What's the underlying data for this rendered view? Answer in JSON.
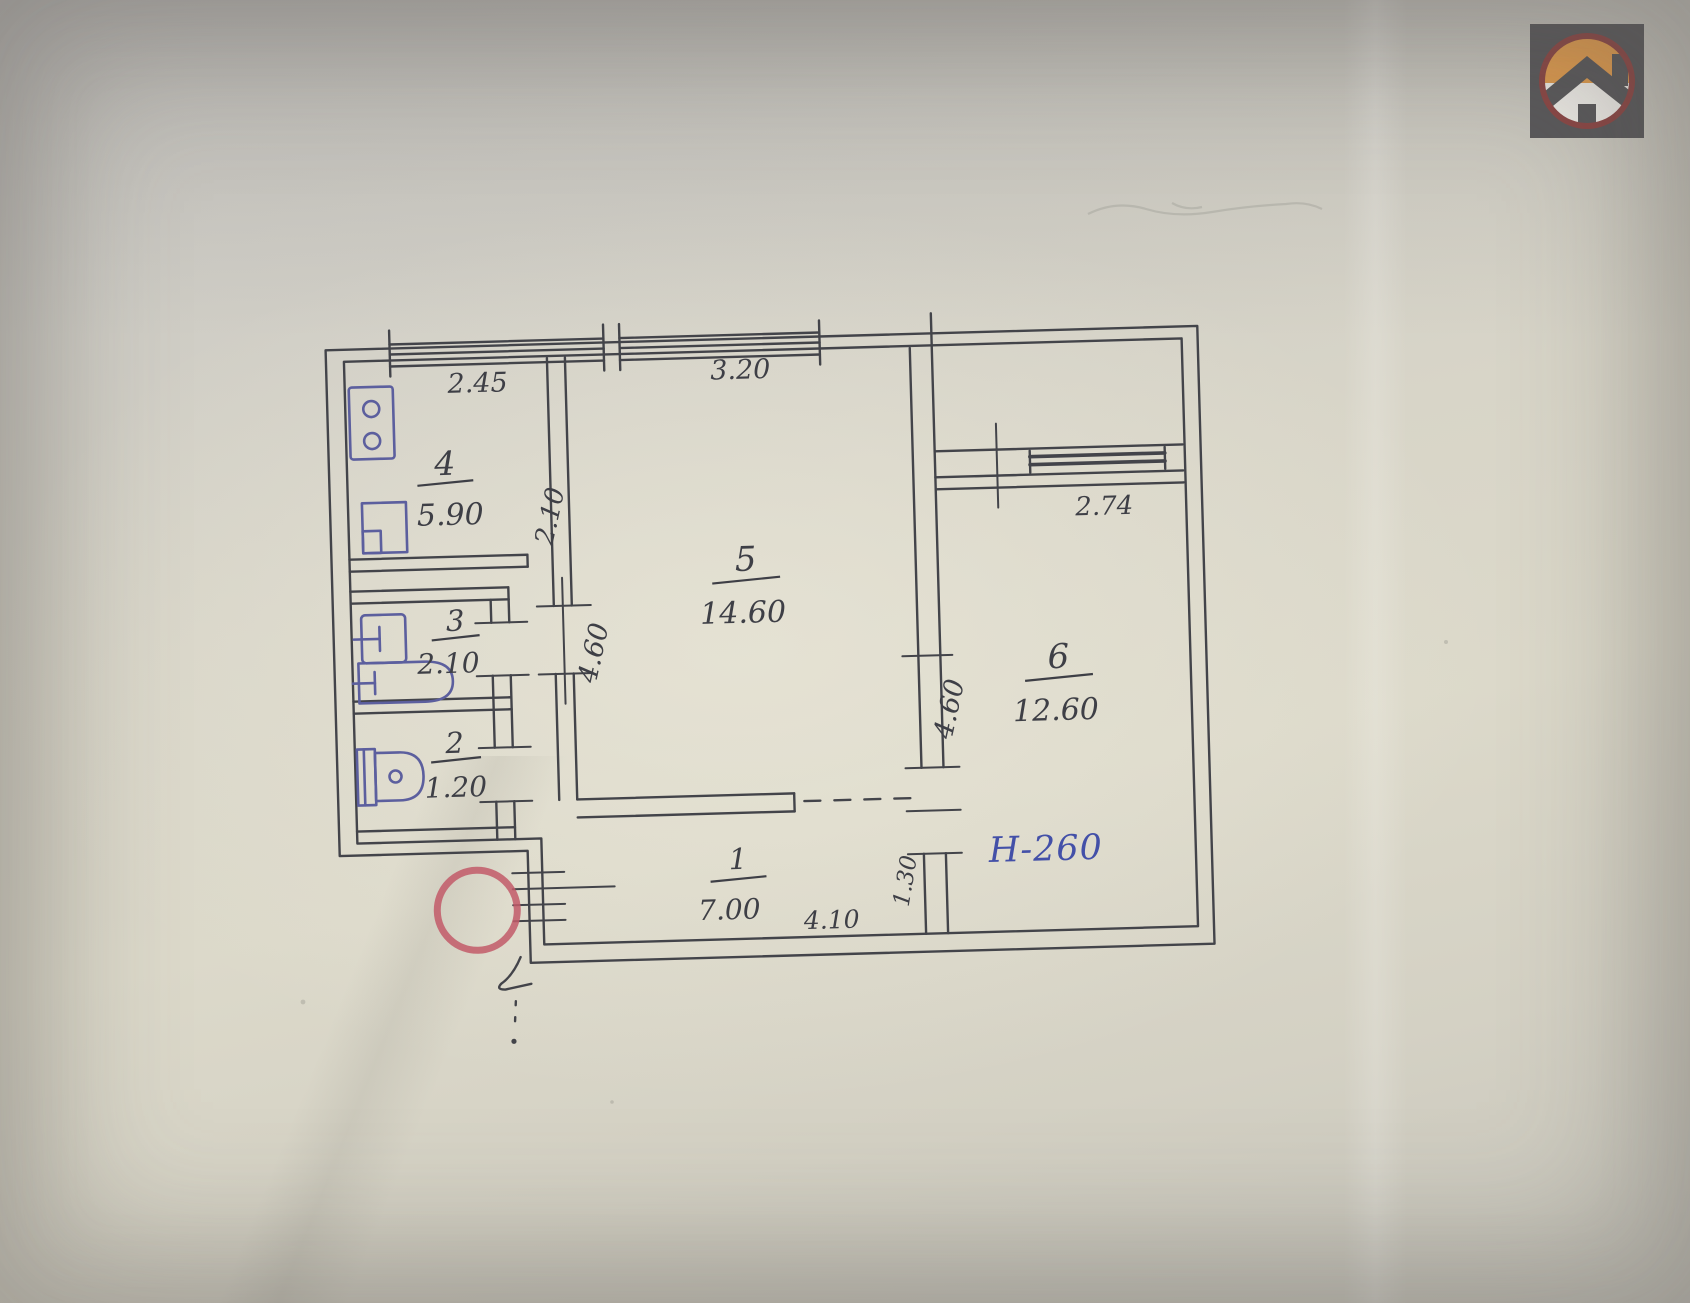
{
  "plan": {
    "rooms": {
      "r1": {
        "number": "1",
        "area": "7.00"
      },
      "r2": {
        "number": "2",
        "area": "1.20"
      },
      "r3": {
        "number": "3",
        "area": "2.10"
      },
      "r4": {
        "number": "4",
        "area": "5.90"
      },
      "r5": {
        "number": "5",
        "area": "14.60"
      },
      "r6": {
        "number": "6",
        "area": "12.60"
      }
    },
    "dims": {
      "kitchen_width": "2.45",
      "room5_width": "3.20",
      "room6_window": "2.74",
      "kitchen_depth": "2.10",
      "room5_depth": "4.60",
      "room6_depth": "4.60",
      "hall_width": "4.10",
      "room6_door": "1.30",
      "height_note": "Н-260"
    }
  },
  "colors": {
    "ink": "#43444a",
    "fixture_ink": "#5c5f9e",
    "stamp_red": "#c25a68",
    "note_blue": "#4350a8",
    "paper": "#d9d6c7",
    "logo_bg": "#59585a",
    "logo_ring": "#8a4644",
    "logo_orange": "#dd9a4e",
    "logo_white": "#ebe9e4"
  },
  "icons": {
    "logo": "house-icon",
    "fixtures": [
      "stove-icon",
      "kitchen-sink-icon",
      "washbasin-icon",
      "bathtub-icon",
      "toilet-icon"
    ],
    "marks": [
      "stamp-circle",
      "entrance-arrow-icon"
    ]
  }
}
